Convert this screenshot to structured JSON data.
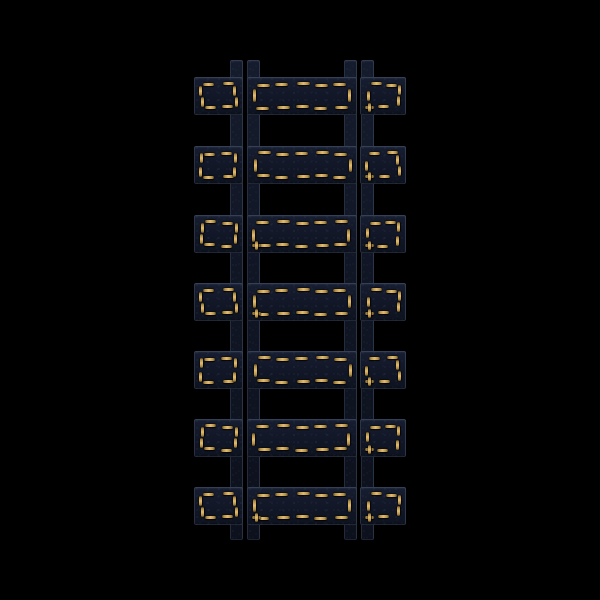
{
  "scene": {
    "width": 600,
    "height": 600,
    "background": "#000000",
    "subject": "denim-railroad-track-with-gold-stitching",
    "colors": {
      "denim_base": "#121828",
      "denim_highlight": "#171e31",
      "denim_shadow": "#0e1320",
      "edge_fray": "#6e7e9b",
      "stitch_core": "#e2bc6f",
      "stitch_mid": "#b28f47",
      "stitch_end": "#5e461d",
      "background": "#000000"
    },
    "rails": {
      "top": 60,
      "height": 480,
      "width": 13,
      "x_positions": [
        230,
        247,
        344,
        361
      ]
    },
    "ties": {
      "tops": [
        77,
        146,
        215,
        283,
        351,
        419,
        487
      ],
      "height": 38,
      "segments": [
        {
          "role": "tie-left-tab",
          "x": 194,
          "w": 49,
          "stitch": {
            "inset": 7,
            "top": 2,
            "bottom": 2,
            "left": 2,
            "right": 2,
            "dash_w": 11,
            "dash_h": 10,
            "plus": false
          }
        },
        {
          "role": "tie-middle-bar",
          "x": 247,
          "w": 110,
          "stitch": {
            "inset": 7,
            "top": 5,
            "bottom": 5,
            "left": 1,
            "right": 1,
            "dash_w": 13,
            "dash_h": 13,
            "plus": false
          }
        },
        {
          "role": "tie-right-tab",
          "x": 360,
          "w": 46,
          "stitch": {
            "inset": 7,
            "top": 2,
            "bottom": 1,
            "left": 1,
            "right": 2,
            "dash_w": 11,
            "dash_h": 10,
            "plus": true
          }
        }
      ],
      "middle_plus_tie_indices": [
        2,
        3,
        6
      ]
    }
  }
}
